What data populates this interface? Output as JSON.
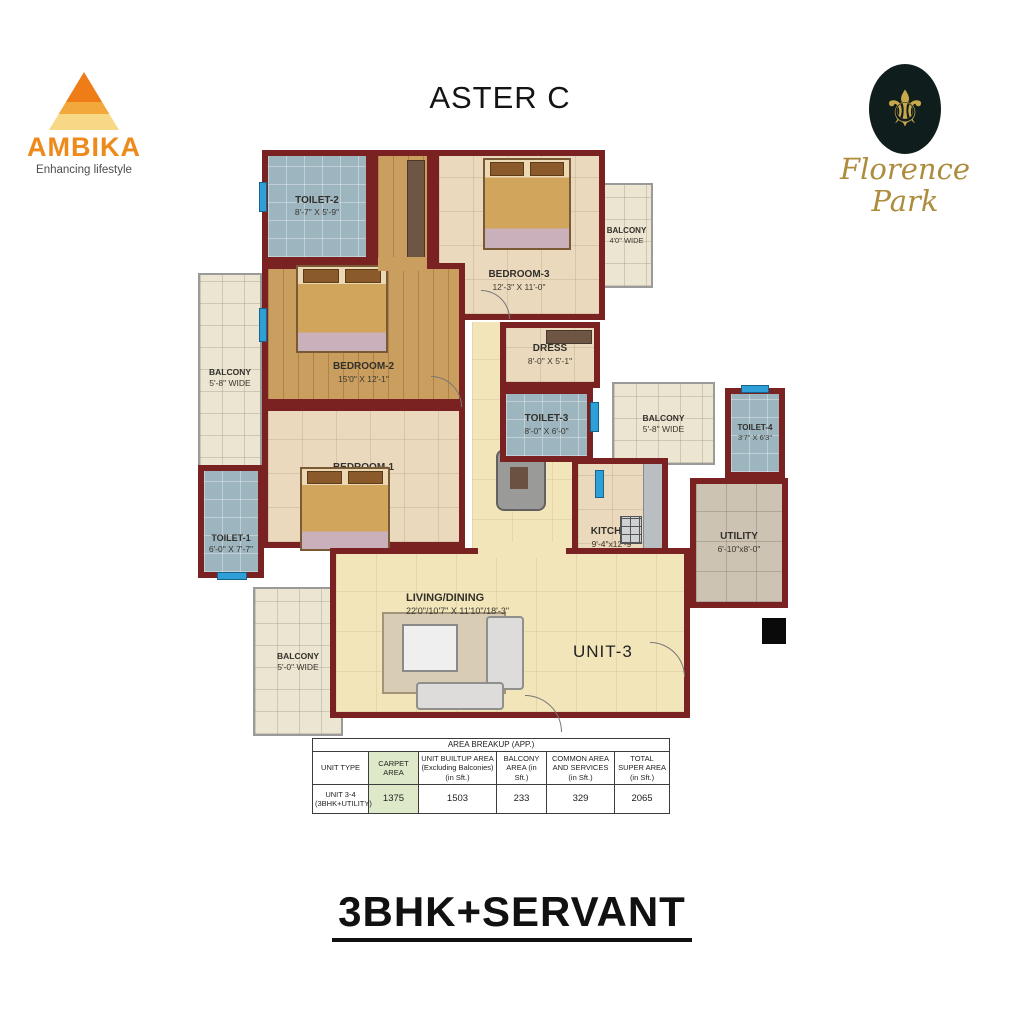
{
  "header": {
    "title": "ASTER C",
    "ambika": {
      "name": "AMBIKA",
      "tagline": "Enhancing lifestyle"
    },
    "florence": {
      "name": "Florence Park",
      "fleur_glyph": "⚜"
    }
  },
  "floorplan": {
    "unit_label": "UNIT-3",
    "rooms": [
      {
        "name": "TOILET-2",
        "dims": "8'-7\" X 5'-9\""
      },
      {
        "name": "BEDROOM-3",
        "dims": "12'-3\" X 11'-0\""
      },
      {
        "name": "BALCONY",
        "dims": "4'0\" WIDE"
      },
      {
        "name": "BALCONY",
        "dims": "5'-8\" WIDE"
      },
      {
        "name": "BEDROOM-2",
        "dims": "15'0\" X 12'-1\""
      },
      {
        "name": "DRESS",
        "dims": "8'-0\" X 5'-1\""
      },
      {
        "name": "TOILET-3",
        "dims": "8'-0\" X 6'-0\""
      },
      {
        "name": "BALCONY",
        "dims": "5'-8\" WIDE"
      },
      {
        "name": "TOILET-4",
        "dims": "3'7\" X 6'3\""
      },
      {
        "name": "BEDROOM-1",
        "dims": "15'-0\" X 10'-6\""
      },
      {
        "name": "TOILET-1",
        "dims": "6'-0\" X 7'-7\""
      },
      {
        "name": "KITCHEN",
        "dims": "9'-4\"x12'-9\""
      },
      {
        "name": "UTILITY",
        "dims": "6'-10\"x8'-0\""
      },
      {
        "name": "LIVING/DINING",
        "dims": "22'0\"/10'7\" X 11'10\"/18'-3\""
      },
      {
        "name": "BALCONY",
        "dims": "5'-0\" WIDE"
      }
    ]
  },
  "table": {
    "title": "AREA BREAKUP (APP.)",
    "headers": [
      "UNIT TYPE",
      "CARPET AREA",
      "UNIT BUILTUP AREA (Excluding Balconies) (in Sft.)",
      "BALCONY AREA (in Sft.)",
      "COMMON AREA AND SERVICES (in Sft.)",
      "TOTAL SUPER AREA (in Sft.)"
    ],
    "row": [
      "UNIT 3-4 (3BHK+UTILITY)",
      "1375",
      "1503",
      "233",
      "329",
      "2065"
    ]
  },
  "footer": {
    "plan_type": "3BHK+SERVANT"
  },
  "colors": {
    "wall": "#7a2222",
    "carpet_column": "#dde9c9",
    "ambika_orange": "#ee8a1c",
    "florence_gold": "#ad8c3c",
    "toilet_floor": "#9db5bf",
    "wood_floor": "#c99e5f",
    "living_floor": "#f2e5ba"
  }
}
